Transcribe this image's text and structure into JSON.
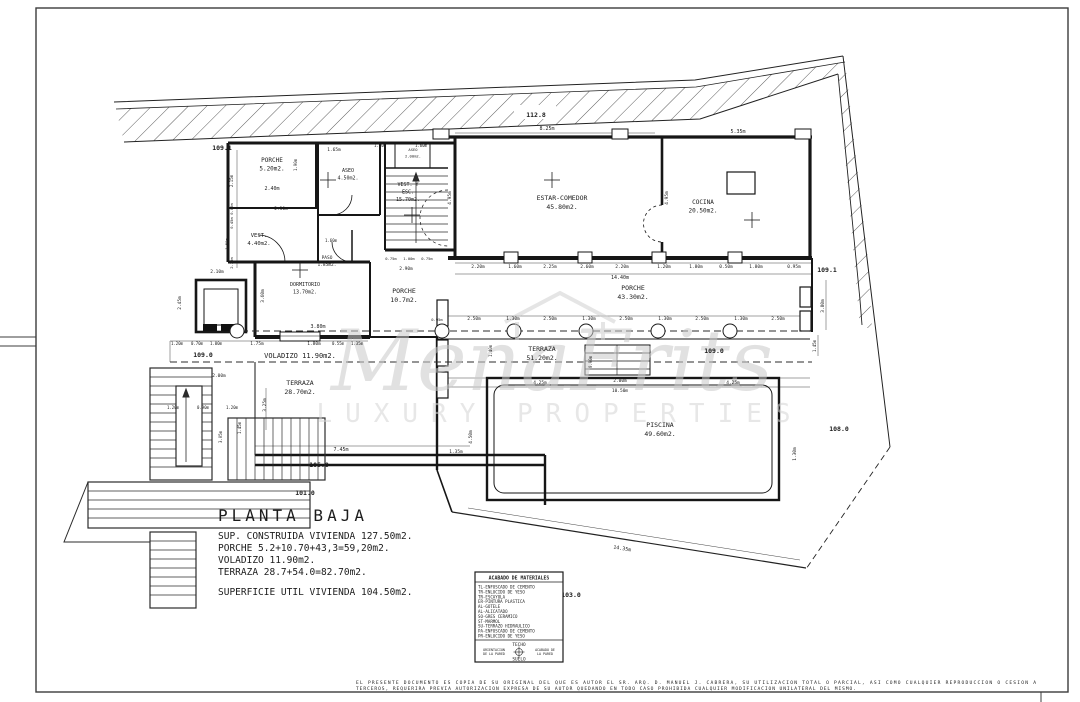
{
  "plan": {
    "sheet_name": "PLANTA BAJA",
    "rooms": [
      {
        "name": "PORCHE",
        "area": "5.20m2.",
        "x": 272,
        "y": 162,
        "s": 6
      },
      {
        "name": "ASEO",
        "area": "4.50m2.",
        "x": 348,
        "y": 172,
        "s": 5
      },
      {
        "name": "ASEO",
        "area": "2.00m2.",
        "x": 413,
        "y": 151,
        "s": 3.8
      },
      {
        "name": "VEST. Y",
        "name2": "ESC.",
        "area": "15.70m2.",
        "x": 408,
        "y": 186,
        "s": 5
      },
      {
        "name": "VEST.",
        "area": "4.40m2.",
        "x": 259,
        "y": 237,
        "s": 5.5
      },
      {
        "name": "PASO",
        "area": "1.85m2.",
        "x": 327,
        "y": 259,
        "s": 4.5
      },
      {
        "name": "DORMITORIO",
        "area": "13.70m2.",
        "x": 305,
        "y": 286,
        "s": 5
      },
      {
        "name": "ESTAR-COMEDOR",
        "area": "45.80m2.",
        "x": 562,
        "y": 200,
        "s": 6.5
      },
      {
        "name": "COCINA",
        "area": "20.50m2.",
        "x": 703,
        "y": 204,
        "s": 6
      },
      {
        "name": "PORCHE",
        "area": "10.7m2.",
        "x": 404,
        "y": 293,
        "s": 6.5
      },
      {
        "name": "PORCHE",
        "area": "43.30m2.",
        "x": 633,
        "y": 290,
        "s": 6.5
      },
      {
        "name": "TERRAZA",
        "area": "51.20m2.",
        "x": 542,
        "y": 351,
        "s": 6.5
      },
      {
        "name": "TERRAZA",
        "area": "28.70m2.",
        "x": 300,
        "y": 385,
        "s": 6.5
      },
      {
        "name": "PISCINA",
        "area": "49.60m2.",
        "x": 660,
        "y": 427,
        "s": 6.5
      }
    ],
    "dimensions": [
      {
        "t": "8.25m",
        "x": 547,
        "y": 130
      },
      {
        "t": "5.35m",
        "x": 738,
        "y": 133
      },
      {
        "t": "1.40m",
        "x": 380,
        "y": 147,
        "s": 4
      },
      {
        "t": "1.60m",
        "x": 421,
        "y": 147,
        "s": 4
      },
      {
        "t": "1.65m",
        "x": 334,
        "y": 151,
        "s": 4.5
      },
      {
        "t": "2.40m",
        "x": 272,
        "y": 190,
        "s": 5
      },
      {
        "t": "1.90m",
        "x": 297,
        "y": 165,
        "v": 1,
        "s": 4
      },
      {
        "t": "2.30m",
        "x": 281,
        "y": 210,
        "s": 4.5
      },
      {
        "t": "1.60m",
        "x": 331,
        "y": 242,
        "s": 4
      },
      {
        "t": "2.10m",
        "x": 217,
        "y": 273,
        "s": 4.5
      },
      {
        "t": "2.15m",
        "x": 233,
        "y": 181,
        "v": 1,
        "s": 4
      },
      {
        "t": "0.80m",
        "x": 233,
        "y": 209,
        "v": 1,
        "s": 3.8
      },
      {
        "t": "0.45m",
        "x": 233,
        "y": 223,
        "v": 1,
        "s": 3.8
      },
      {
        "t": "1.50m",
        "x": 228,
        "y": 244,
        "v": 1,
        "s": 3.8
      },
      {
        "t": "2.20m",
        "x": 233,
        "y": 263,
        "v": 1,
        "s": 3.8
      },
      {
        "t": "2.45m",
        "x": 181,
        "y": 303,
        "v": 1,
        "s": 4.5
      },
      {
        "t": "3.60m",
        "x": 264,
        "y": 296,
        "v": 1,
        "s": 4.5
      },
      {
        "t": "3.80m",
        "x": 318,
        "y": 328,
        "s": 5
      },
      {
        "t": "4.95m",
        "x": 451,
        "y": 198,
        "v": 1,
        "s": 4.5
      },
      {
        "t": "4.95m",
        "x": 668,
        "y": 198,
        "v": 1,
        "s": 4.5
      },
      {
        "t": "2.20m",
        "x": 478,
        "y": 268,
        "s": 4.5
      },
      {
        "t": "1.60m",
        "x": 515,
        "y": 268,
        "s": 4.5
      },
      {
        "t": "2.25m",
        "x": 550,
        "y": 268,
        "s": 4.5
      },
      {
        "t": "2.60m",
        "x": 587,
        "y": 268,
        "s": 4.5
      },
      {
        "t": "2.20m",
        "x": 622,
        "y": 268,
        "s": 4.5
      },
      {
        "t": "1.20m",
        "x": 664,
        "y": 268,
        "s": 4.5
      },
      {
        "t": "1.80m",
        "x": 696,
        "y": 268,
        "s": 4.5
      },
      {
        "t": "0.50m",
        "x": 726,
        "y": 268,
        "s": 4.5
      },
      {
        "t": "1.80m",
        "x": 756,
        "y": 268,
        "s": 4.5
      },
      {
        "t": "0.95m",
        "x": 794,
        "y": 268,
        "s": 4.5
      },
      {
        "t": "14.40m",
        "x": 620,
        "y": 279,
        "s": 5
      },
      {
        "t": "0.75m",
        "x": 391,
        "y": 260,
        "s": 3.8
      },
      {
        "t": "1.00m",
        "x": 409,
        "y": 260,
        "s": 3.8
      },
      {
        "t": "0.75m",
        "x": 427,
        "y": 260,
        "s": 3.8
      },
      {
        "t": "2.90m",
        "x": 406,
        "y": 270,
        "s": 4.5
      },
      {
        "t": "0.95m",
        "x": 437,
        "y": 321,
        "s": 3.8
      },
      {
        "t": "2.50m",
        "x": 474,
        "y": 320,
        "s": 4.5
      },
      {
        "t": "1.30m",
        "x": 513,
        "y": 320,
        "s": 4.5
      },
      {
        "t": "2.50m",
        "x": 550,
        "y": 320,
        "s": 4.5
      },
      {
        "t": "1.30m",
        "x": 589,
        "y": 320,
        "s": 4.5
      },
      {
        "t": "2.50m",
        "x": 626,
        "y": 320,
        "s": 4.5
      },
      {
        "t": "1.30m",
        "x": 665,
        "y": 320,
        "s": 4.5
      },
      {
        "t": "2.50m",
        "x": 702,
        "y": 320,
        "s": 4.5
      },
      {
        "t": "1.30m",
        "x": 741,
        "y": 320,
        "s": 4.5
      },
      {
        "t": "2.50m",
        "x": 778,
        "y": 320,
        "s": 4.5
      },
      {
        "t": "1.20m",
        "x": 177,
        "y": 345,
        "s": 4
      },
      {
        "t": "0.70m",
        "x": 197,
        "y": 345,
        "s": 4
      },
      {
        "t": "1.00m",
        "x": 216,
        "y": 345,
        "s": 4
      },
      {
        "t": "1.75m",
        "x": 257,
        "y": 345,
        "s": 4.5
      },
      {
        "t": "1.80m",
        "x": 314,
        "y": 345,
        "s": 4.5
      },
      {
        "t": "0.55m",
        "x": 338,
        "y": 345,
        "s": 4
      },
      {
        "t": "1.35m",
        "x": 357,
        "y": 345,
        "s": 4
      },
      {
        "t": "VOLADIZO  11.90m2.",
        "x": 300,
        "y": 358,
        "s": 7
      },
      {
        "t": "2.00m",
        "x": 219,
        "y": 377,
        "s": 4.5
      },
      {
        "t": "1.20m",
        "x": 173,
        "y": 409,
        "s": 4
      },
      {
        "t": "0.90m",
        "x": 203,
        "y": 409,
        "s": 4
      },
      {
        "t": "1.20m",
        "x": 232,
        "y": 409,
        "s": 4
      },
      {
        "t": "1.45m",
        "x": 241,
        "y": 428,
        "v": 1,
        "s": 4
      },
      {
        "t": "3.05m",
        "x": 222,
        "y": 437,
        "v": 1,
        "s": 4
      },
      {
        "t": "3.25m",
        "x": 266,
        "y": 405,
        "v": 1,
        "s": 4.5
      },
      {
        "t": "7.45m",
        "x": 341,
        "y": 451,
        "s": 5
      },
      {
        "t": "1.35m",
        "x": 456,
        "y": 453,
        "s": 4.5
      },
      {
        "t": "1.40m",
        "x": 492,
        "y": 351,
        "v": 1,
        "s": 4
      },
      {
        "t": "0.90m",
        "x": 592,
        "y": 362,
        "v": 1,
        "s": 4
      },
      {
        "t": "4.25m",
        "x": 540,
        "y": 384,
        "s": 4.5
      },
      {
        "t": "2.00m",
        "x": 620,
        "y": 382,
        "s": 4.5
      },
      {
        "t": "4.25m",
        "x": 733,
        "y": 384,
        "s": 4.5
      },
      {
        "t": "10.50m",
        "x": 620,
        "y": 392,
        "s": 4.5
      },
      {
        "t": "4.50m",
        "x": 472,
        "y": 437,
        "v": 1,
        "s": 4.5
      },
      {
        "t": "1.30m",
        "x": 796,
        "y": 454,
        "v": 1,
        "s": 4.5
      },
      {
        "t": "3.80m",
        "x": 824,
        "y": 306,
        "v": 1,
        "s": 4.5
      },
      {
        "t": "1.45m",
        "x": 816,
        "y": 346,
        "v": 1,
        "s": 4
      },
      {
        "t": "14.35m",
        "x": 622,
        "y": 550,
        "r": 9,
        "s": 5
      }
    ],
    "elevations": [
      {
        "t": "112.8",
        "x": 536,
        "y": 117
      },
      {
        "t": "109.1",
        "x": 222,
        "y": 150
      },
      {
        "t": "109.1",
        "x": 827,
        "y": 272
      },
      {
        "t": "109.0",
        "x": 203,
        "y": 357
      },
      {
        "t": "109.0",
        "x": 714,
        "y": 353
      },
      {
        "t": "108.0",
        "x": 839,
        "y": 431
      },
      {
        "t": "105.0",
        "x": 319,
        "y": 467
      },
      {
        "t": "101.0",
        "x": 305,
        "y": 495
      },
      {
        "t": "103.0",
        "x": 571,
        "y": 597
      }
    ]
  },
  "summary": {
    "title": "PLANTA BAJA",
    "lines": [
      "SUP. CONSTRUIDA VIVIENDA 127.50m2.",
      "PORCHE 5.2+10.70+43,3=59,20m2.",
      "VOLADIZO 11.90m2.",
      "TERRAZA 28.7+54.0=82.70m2.",
      "SUPERFICIE UTIL VIVIENDA 104.50m2."
    ]
  },
  "legend": {
    "title": "ACABADO DE MATERIALES",
    "materials": [
      "TL-ENFOSCADO DE CEMENTO",
      "TR-ENLUCIDO DE YESO",
      "TR-ESCAYOLA",
      "ER-PINTURA PLASTICA",
      "AL-GOTELE",
      "AL-ALICATADO",
      "SO-GRES CERAMICO",
      "ST-MARMOL",
      "SU-TERRAZO HIDRAULICO",
      "PA-ENFOSCADO DE CEMENTO",
      "PR-ENLUCIDO DE YESO"
    ],
    "techo": "TECHO",
    "suelo": "SUELO",
    "orientacion_l1": "ORIENTACION",
    "orientacion_l2": "DE LA PARED",
    "acabado_l1": "ACABADO DE",
    "acabado_l2": "LA PARED"
  },
  "watermark": {
    "brand": "MenaFrits",
    "tagline": "LUXURY PROPERTIES"
  },
  "disclaimer": {
    "line1": "EL PRESENTE DOCUMENTO ES COPIA DE SU ORIGINAL DEL QUE ES AUTOR EL SR. ARQ. D. MANUEL J. CABRERA, SU UTILIZACION TOTAL O PARCIAL, ASI COMO CUALQUIER REPRODUCCION O CESION A",
    "line2": "TERCEROS, REQUERIRA PREVIA AUTORIZACION EXPRESA DE SU AUTOR QUEDANDO EN TODO CASO PROHIBIDA CUALQUIER MODIFICACION UNILATERAL DEL MISMO."
  }
}
